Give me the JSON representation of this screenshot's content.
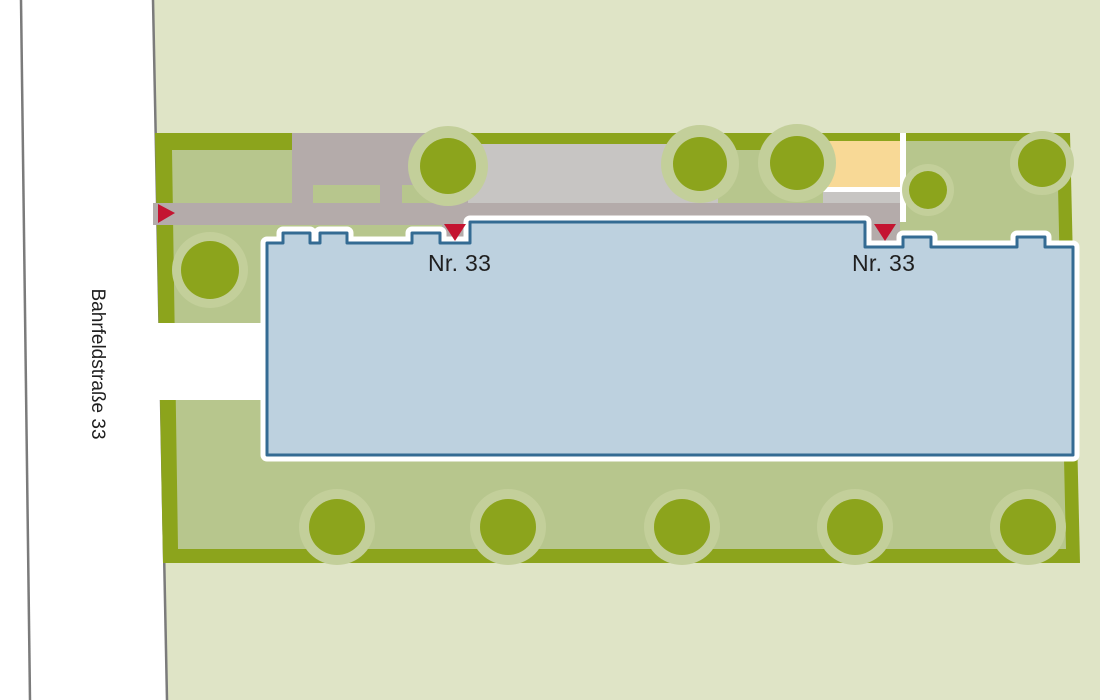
{
  "site_plan": {
    "street": {
      "label": "Bahrfeldstraße 33"
    },
    "building": {
      "label_left": "Nr. 33",
      "label_right": "Nr. 33"
    }
  },
  "colors": {
    "street": "#ffffff",
    "surround": "#dfe4c6",
    "border": "#8ca41c",
    "lawn": "#b7c68d",
    "tree": "#8ca41c",
    "tree_halo": "#c3cf9a",
    "path": "#b4abaa",
    "parking": "#c7c5c3",
    "playground": "#f8d996",
    "building_fill": "#bdd1df",
    "building_stroke": "#346b93",
    "marker": "#c41431",
    "boundary_line": "#7b7b7b",
    "outline_white": "#ffffff",
    "text": "#1f1f1f"
  }
}
